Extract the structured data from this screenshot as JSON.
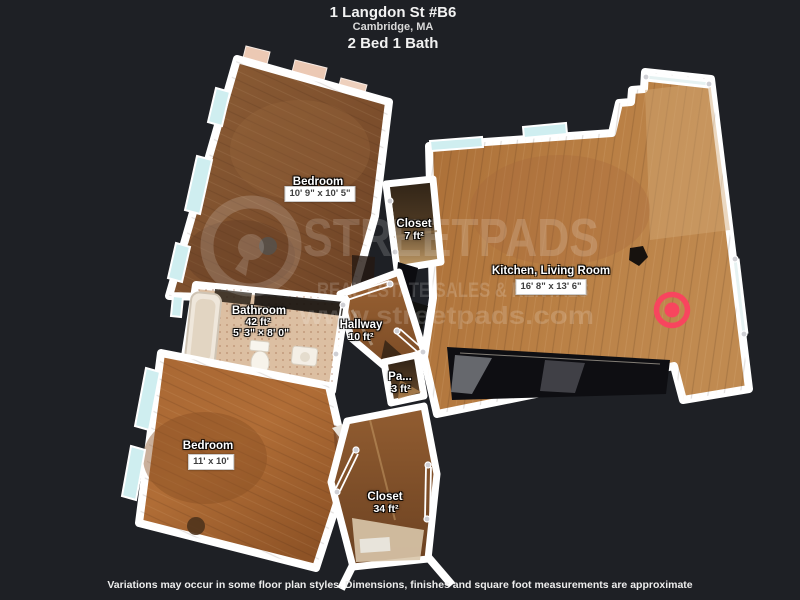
{
  "header": {
    "title": "1 Langdon St #B6",
    "subtitle": "Cambridge, MA",
    "beds_baths": "2 Bed 1 Bath"
  },
  "rooms": {
    "bedroom_top": {
      "name": "Bedroom",
      "dims": "10' 9\" x 10' 5\""
    },
    "closet_small": {
      "name": "Closet",
      "area": "7 ft²"
    },
    "kitchen_living": {
      "name": "Kitchen, Living Room",
      "dims": "16' 8\" x 13' 6\""
    },
    "bathroom": {
      "name": "Bathroom",
      "area": "42 ft²",
      "dims": "5' 3\" × 8' 0\""
    },
    "hallway": {
      "name": "Hallway",
      "area": "10 ft²"
    },
    "pantry": {
      "name": "Pa...",
      "area": "3 ft²"
    },
    "bedroom_bottom": {
      "name": "Bedroom",
      "dims": "11' x 10'"
    },
    "closet_large": {
      "name": "Closet",
      "area": "34 ft²"
    }
  },
  "watermark": {
    "brand": "STREETPADS",
    "tagline": "REAL ESTATE SALES & RENTALS",
    "website": "www.streetpads.com"
  },
  "footer": {
    "disclaimer": "Variations may occur in some floor plan styles. Dimensions, finishes and square foot measurements are approximate"
  },
  "icons": {
    "camera_marker": "camera-location-marker",
    "logo": "streetpads-logo"
  },
  "colors": {
    "background": "#1e2025",
    "wall": "#ffffff",
    "marker_red": "#f8455e",
    "window_glass": "#cfeef0"
  }
}
